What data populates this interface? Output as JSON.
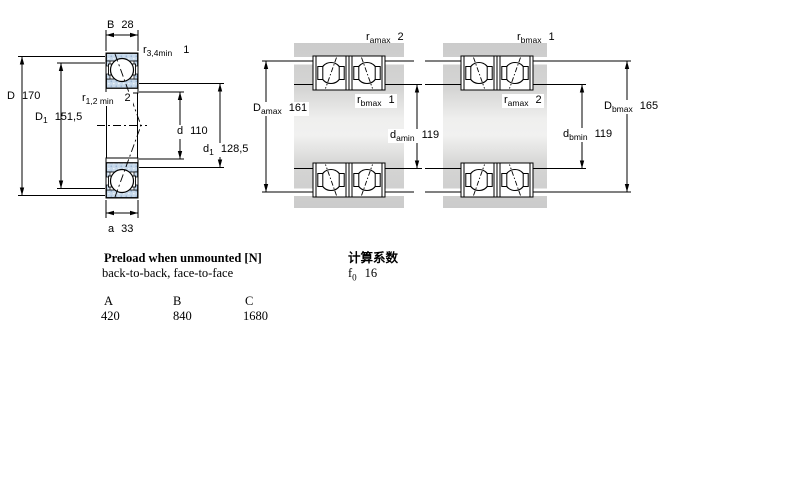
{
  "left_diagram": {
    "labels": {
      "B": {
        "base": "B",
        "value": "28"
      },
      "r34": {
        "base": "r",
        "sub": "3,4min",
        "value": "1"
      },
      "D": {
        "base": "D",
        "value": "170"
      },
      "D1": {
        "base": "D",
        "sub": "1",
        "value": "151,5"
      },
      "r12": {
        "base": "r",
        "sub": "1,2 min",
        "value": "2"
      },
      "d": {
        "base": "d",
        "value": "110"
      },
      "d1": {
        "base": "d",
        "sub": "1",
        "value": "128,5"
      },
      "a": {
        "base": "a",
        "value": "33"
      }
    }
  },
  "middle_diagram": {
    "arrangement": "back-to-back",
    "labels": {
      "ramax": {
        "base": "r",
        "sub": "amax",
        "value": "2"
      },
      "Damax": {
        "base": "D",
        "sub": "amax",
        "value": "161"
      },
      "rbmax": {
        "base": "r",
        "sub": "bmax",
        "value": "1"
      },
      "damin": {
        "base": "d",
        "sub": "amin",
        "value": "119"
      }
    }
  },
  "right_diagram": {
    "arrangement": "face-to-face",
    "labels": {
      "rbmax": {
        "base": "r",
        "sub": "bmax",
        "value": "1"
      },
      "ramax": {
        "base": "r",
        "sub": "amax",
        "value": "2"
      },
      "Dbmax": {
        "base": "D",
        "sub": "bmax",
        "value": "165"
      },
      "dbmin": {
        "base": "d",
        "sub": "bmin",
        "value": "119"
      }
    }
  },
  "preload": {
    "title": "Preload when unmounted [N]",
    "subtitle": "back-to-back, face-to-face",
    "columns": [
      "A",
      "B",
      "C"
    ],
    "values": [
      "420",
      "840",
      "1680"
    ]
  },
  "calc": {
    "title": "计算系数",
    "f0": {
      "base": "f",
      "sub": "0",
      "value": "16"
    }
  },
  "colors": {
    "ring_fill": "#c6d8ea",
    "ring_dot": "#9cb6d5",
    "housing_gray": "#cbcbcb",
    "shaft_light": "#f1f1f0",
    "line": "#000000"
  }
}
